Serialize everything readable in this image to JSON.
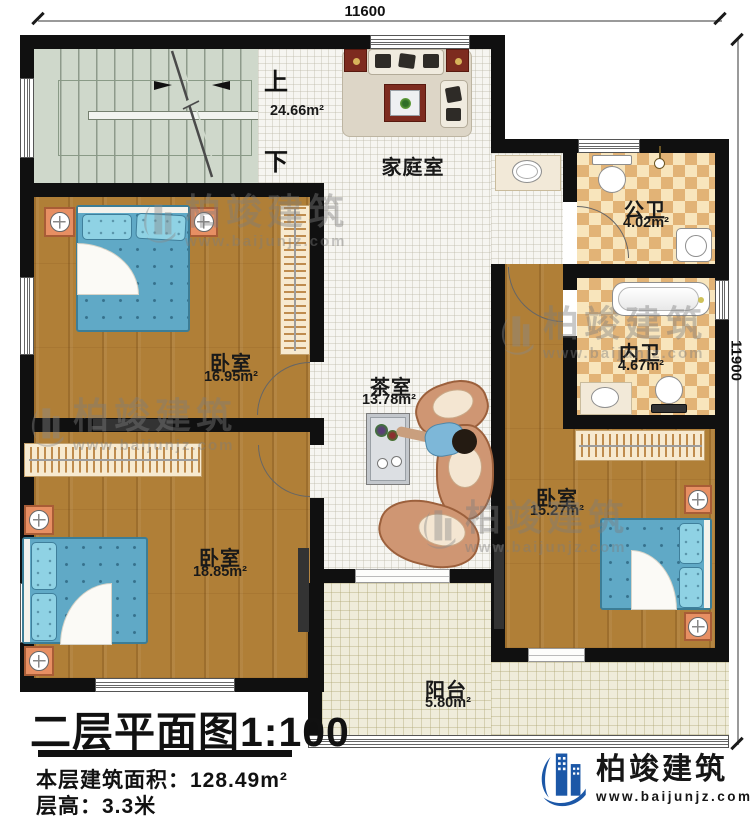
{
  "dimensions": {
    "top": "11600",
    "right": "11900"
  },
  "stair": {
    "up_label": "上",
    "down_label": "下"
  },
  "rooms": {
    "family": {
      "name": "家庭室",
      "area": "24.66m²"
    },
    "public_bath": {
      "name": "公卫",
      "area": "4.02m²"
    },
    "inner_bath": {
      "name": "内卫",
      "area": "4.67m²"
    },
    "bedroom_top_left": {
      "name": "卧室",
      "area": "16.95m²"
    },
    "tea": {
      "name": "茶室",
      "area": "13.78m²"
    },
    "bedroom_bottom_left": {
      "name": "卧室",
      "area": "18.85m²"
    },
    "bedroom_right": {
      "name": "卧室",
      "area": "15.27m²"
    },
    "balcony": {
      "name": "阳台",
      "area": "5.80m²"
    }
  },
  "title_block": {
    "title": "二层平面图1:100",
    "area_label": "本层建筑面积：",
    "area_value": "128.49m²",
    "height_label": "层高：",
    "height_value": "3.3米"
  },
  "branding": {
    "company": "柏竣建筑",
    "website": "www.baijunjz.com"
  },
  "watermark": {
    "company": "柏竣建筑",
    "website": "www.baijunjz.com"
  },
  "colors": {
    "wall": "#101010",
    "wood": "#b07f37",
    "tile": "#f6f5f1",
    "bath_checker": "#e2b376",
    "stair": "#cfd8cb",
    "balcony": "#efecda",
    "bed": "#60a9c6",
    "logo_blue": "#1b57a7"
  }
}
